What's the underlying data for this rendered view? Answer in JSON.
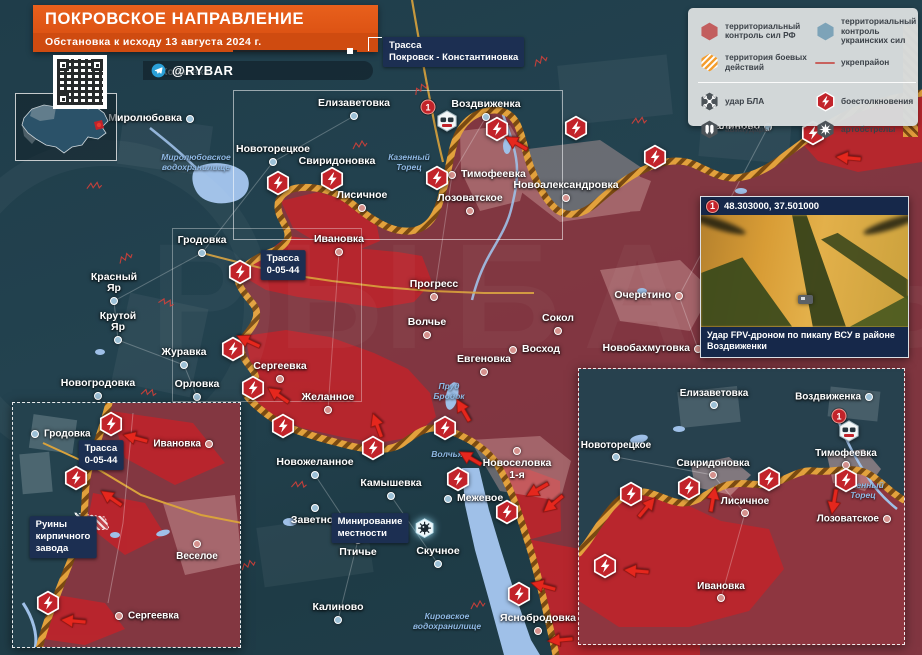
{
  "header": {
    "title": "ПОКРОВСКОЕ НАПРАВЛЕНИЕ",
    "subtitle": "Обстановка к исходу 13 августа 2024 г.",
    "channel": "@RYBAR"
  },
  "watermark": "РЫБАРЬ",
  "legend": {
    "items": [
      {
        "ic": "hex-red",
        "label": "территориальный контроль сил РФ"
      },
      {
        "ic": "hex-blue",
        "label": "территориальный контроль украинских сил"
      },
      {
        "ic": "hex-striped",
        "label": "территория боевых действий"
      },
      {
        "ic": "line-red",
        "label": "укрепрайон"
      },
      {
        "ic": "hex-uav",
        "label": "удар БЛА"
      },
      {
        "ic": "diamond-clash",
        "label": "боестолкновения"
      },
      {
        "ic": "hex-avia",
        "label": "авиаудары"
      },
      {
        "ic": "hex-arty",
        "label": "артобстрелы"
      }
    ]
  },
  "photo_inset": {
    "marker": "1",
    "coords": "48.303000, 37.501000",
    "caption": "Удар FPV-дроном по пикапу ВСУ в районе Воздвиженки"
  },
  "colors": {
    "banner_orange": "#e05a17",
    "rf_zone": "#8e3640",
    "advance_red": "#c2232a",
    "ua_teal": "#24424e",
    "frontline": "#e2a13c",
    "combat_icon": "#c2232a",
    "legend_bg": "#d8dcdd",
    "label_navy": "#1c2f52",
    "water": "#9fc0e8"
  },
  "maps": {
    "main": {
      "towns": [
        {
          "n": "Миролюбовка",
          "x": 190,
          "y": 119,
          "s": "ua",
          "lp": "left"
        },
        {
          "n": "Копаевка",
          "x": 152,
          "y": 73,
          "s": "ua",
          "lp": "right",
          "dim": 1,
          "nodot": 1
        },
        {
          "n": "Елизаветовка",
          "x": 354,
          "y": 116,
          "s": "ua",
          "lp": "above"
        },
        {
          "n": "Воздвиженка",
          "x": 486,
          "y": 117,
          "s": "ua",
          "lp": "above"
        },
        {
          "n": "Калиново",
          "x": 768,
          "y": 127,
          "s": "ua",
          "lp": "left"
        },
        {
          "n": "Новоторецкое",
          "x": 273,
          "y": 162,
          "s": "ua",
          "lp": "above"
        },
        {
          "n": "Свиридоновка",
          "x": 337,
          "y": 174,
          "s": "ru",
          "lp": "above"
        },
        {
          "n": "Тимофеевка",
          "x": 452,
          "y": 175,
          "s": "ru",
          "lp": "right"
        },
        {
          "n": "Новоалександровка",
          "x": 566,
          "y": 198,
          "s": "ru",
          "lp": "above"
        },
        {
          "n": "Лисичное",
          "x": 362,
          "y": 208,
          "s": "ru",
          "lp": "above"
        },
        {
          "n": "Лозоватское",
          "x": 470,
          "y": 211,
          "s": "ru",
          "lp": "above"
        },
        {
          "n": "Гродовка",
          "x": 202,
          "y": 253,
          "s": "ua",
          "lp": "above"
        },
        {
          "n": "Ивановка",
          "x": 339,
          "y": 252,
          "s": "ru",
          "lp": "above"
        },
        {
          "n": "Красный Яр",
          "x": 114,
          "y": 301,
          "s": "ua",
          "lp": "above"
        },
        {
          "n": "Прогресс",
          "x": 434,
          "y": 297,
          "s": "ru",
          "lp": "above"
        },
        {
          "n": "Волчье",
          "x": 427,
          "y": 335,
          "s": "ru",
          "lp": "above"
        },
        {
          "n": "Крутой Яр",
          "x": 118,
          "y": 340,
          "s": "ua",
          "lp": "above"
        },
        {
          "n": "Сокол",
          "x": 558,
          "y": 331,
          "s": "ru",
          "lp": "above"
        },
        {
          "n": "Очеретино",
          "x": 679,
          "y": 296,
          "s": "ru",
          "lp": "left"
        },
        {
          "n": "Восход",
          "x": 513,
          "y": 350,
          "s": "ru",
          "lp": "right"
        },
        {
          "n": "Евгеновка",
          "x": 484,
          "y": 372,
          "s": "ru",
          "lp": "above"
        },
        {
          "n": "Новобахмутовка",
          "x": 698,
          "y": 349,
          "s": "ru",
          "lp": "left"
        },
        {
          "n": "Журавка",
          "x": 184,
          "y": 365,
          "s": "ua",
          "lp": "above"
        },
        {
          "n": "Сергеевка",
          "x": 280,
          "y": 379,
          "s": "ru",
          "lp": "above"
        },
        {
          "n": "Новогродовка",
          "x": 98,
          "y": 396,
          "s": "ua",
          "lp": "above"
        },
        {
          "n": "Орловка",
          "x": 197,
          "y": 397,
          "s": "ua",
          "lp": "above"
        },
        {
          "n": "Желанное",
          "x": 328,
          "y": 410,
          "s": "ru",
          "lp": "above"
        },
        {
          "n": "Новоселовка\n1-я",
          "x": 517,
          "y": 451,
          "s": "ru",
          "lp": "below"
        },
        {
          "n": "Новожеланное",
          "x": 315,
          "y": 475,
          "s": "ua",
          "lp": "above"
        },
        {
          "n": "Камышевка",
          "x": 391,
          "y": 496,
          "s": "ua",
          "lp": "above"
        },
        {
          "n": "Межевое",
          "x": 448,
          "y": 499,
          "s": "ua",
          "lp": "right"
        },
        {
          "n": "Заветное",
          "x": 315,
          "y": 508,
          "s": "ua",
          "lp": "below"
        },
        {
          "n": "Птичье",
          "x": 358,
          "y": 540,
          "s": "ua",
          "lp": "below"
        },
        {
          "n": "Скучное",
          "x": 438,
          "y": 564,
          "s": "ua",
          "lp": "above"
        },
        {
          "n": "Калиново",
          "x": 338,
          "y": 620,
          "s": "ua",
          "lp": "above"
        },
        {
          "n": "Яснобродовка",
          "x": 538,
          "y": 631,
          "s": "ru",
          "lp": "above"
        }
      ],
      "water_labels": [
        {
          "x": 196,
          "y": 163,
          "t": "Миролюбовское\nводохранилище"
        },
        {
          "x": 409,
          "y": 163,
          "t": "Казенный\nТорец"
        },
        {
          "x": 449,
          "y": 392,
          "t": "Пруд\nБродок"
        },
        {
          "x": 447,
          "y": 455,
          "t": "Волчья"
        },
        {
          "x": 447,
          "y": 622,
          "t": "Кировское\nводохранилище"
        }
      ],
      "box_labels": [
        {
          "x": 383,
          "y": 37,
          "lines": [
            "Трасса",
            "Покровск - Константиновка"
          ],
          "anchor": "tl"
        },
        {
          "x": 283,
          "y": 265,
          "lines": [
            "Трасса",
            "0-05-44"
          ]
        },
        {
          "x": 370,
          "y": 528,
          "lines": [
            "Минирование",
            "местности"
          ],
          "mine": 1
        }
      ],
      "combat": [
        [
          278,
          183
        ],
        [
          332,
          179
        ],
        [
          240,
          272
        ],
        [
          437,
          178
        ],
        [
          497,
          129
        ],
        [
          576,
          128
        ],
        [
          655,
          157
        ],
        [
          813,
          133
        ],
        [
          233,
          349
        ],
        [
          253,
          388
        ],
        [
          283,
          426
        ],
        [
          373,
          448
        ],
        [
          445,
          428
        ],
        [
          458,
          479
        ],
        [
          507,
          512
        ],
        [
          519,
          594
        ],
        [
          604,
          566
        ]
      ],
      "arrows": [
        [
          516,
          143,
          210
        ],
        [
          848,
          158,
          185
        ],
        [
          248,
          341,
          205
        ],
        [
          278,
          395,
          215
        ],
        [
          377,
          425,
          250
        ],
        [
          463,
          410,
          240
        ],
        [
          470,
          458,
          210
        ],
        [
          537,
          490,
          150
        ],
        [
          553,
          504,
          140
        ],
        [
          543,
          586,
          195
        ],
        [
          627,
          567,
          185
        ],
        [
          560,
          640,
          175
        ]
      ],
      "forts": [
        [
          150,
          390,
          20
        ],
        [
          125,
          255,
          -15
        ],
        [
          95,
          183,
          10
        ],
        [
          168,
          300,
          30
        ],
        [
          360,
          142,
          0
        ],
        [
          420,
          86,
          -20
        ],
        [
          300,
          482,
          15
        ],
        [
          248,
          562,
          -10
        ],
        [
          205,
          601,
          25
        ],
        [
          478,
          602,
          0
        ],
        [
          640,
          118,
          10
        ],
        [
          540,
          58,
          -15
        ]
      ],
      "photo_marker": {
        "x": 428,
        "y": 107,
        "hx": 447,
        "hy": 121
      }
    },
    "inset_left": {
      "towns": [
        {
          "n": "Гродовка",
          "x": 22,
          "y": 31,
          "s": "ua",
          "lp": "right"
        },
        {
          "n": "Ивановка",
          "x": 196,
          "y": 41,
          "s": "ru",
          "lp": "left"
        },
        {
          "n": "Веселое",
          "x": 184,
          "y": 141,
          "s": "ru",
          "lp": "below"
        },
        {
          "n": "Сергеевка",
          "x": 106,
          "y": 213,
          "s": "ru",
          "lp": "right"
        }
      ],
      "box_labels": [
        {
          "x": 88,
          "y": 52,
          "lines": [
            "Трасса",
            "0-05-44"
          ]
        },
        {
          "x": 50,
          "y": 134,
          "lines": [
            "Руины",
            "кирпичного",
            "завода"
          ]
        }
      ],
      "combat": [
        [
          98,
          21
        ],
        [
          63,
          75
        ],
        [
          35,
          200
        ]
      ],
      "arrows": [
        [
          122,
          35,
          195
        ],
        [
          98,
          95,
          215
        ],
        [
          60,
          218,
          185
        ]
      ]
    },
    "inset_right": {
      "towns": [
        {
          "n": "Елизаветовка",
          "x": 135,
          "y": 36,
          "s": "ua",
          "lp": "above"
        },
        {
          "n": "Воздвиженка",
          "x": 290,
          "y": 28,
          "s": "ua",
          "lp": "left"
        },
        {
          "n": "Новоторецкое",
          "x": 37,
          "y": 88,
          "s": "ua",
          "lp": "above"
        },
        {
          "n": "Свиридоновка",
          "x": 134,
          "y": 106,
          "s": "ru",
          "lp": "above"
        },
        {
          "n": "Тимофеевка",
          "x": 267,
          "y": 96,
          "s": "ru",
          "lp": "above"
        },
        {
          "n": "Лисичное",
          "x": 166,
          "y": 144,
          "s": "ru",
          "lp": "above"
        },
        {
          "n": "Лозоватское",
          "x": 308,
          "y": 150,
          "s": "ru",
          "lp": "left"
        },
        {
          "n": "Ивановка",
          "x": 142,
          "y": 229,
          "s": "ru",
          "lp": "above"
        }
      ],
      "water_labels": [
        {
          "x": 284,
          "y": 122,
          "t": "Казенный\nТорец"
        }
      ],
      "combat": [
        [
          52,
          125
        ],
        [
          110,
          119
        ],
        [
          190,
          110
        ],
        [
          267,
          111
        ],
        [
          26,
          197
        ]
      ],
      "arrows": [
        [
          68,
          138,
          310
        ],
        [
          134,
          130,
          280
        ],
        [
          255,
          133,
          100
        ],
        [
          57,
          202,
          185
        ]
      ],
      "photo_marker": {
        "x": 260,
        "y": 47,
        "hx": 270,
        "hy": 62
      }
    }
  }
}
